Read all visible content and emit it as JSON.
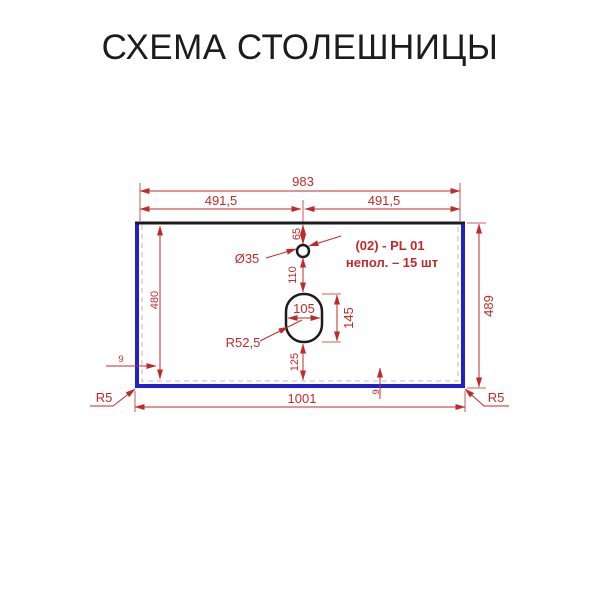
{
  "title": "СХЕМА СТОЛЕШНИЦЫ",
  "colors": {
    "dimension": "#c22a2a",
    "edge": "#2121cc",
    "outline": "#1c1c1c",
    "background": "#ffffff"
  },
  "diagram": {
    "dims": {
      "top_total": "983",
      "top_left": "491,5",
      "top_right": "491,5",
      "hole_offset": "65",
      "hole_dia": "Ø35",
      "hole_to_cutout": "110",
      "cutout_width": "105",
      "cutout_height": "145",
      "cutout_radius": "R52,5",
      "cutout_bottom": "125",
      "inner_height": "480",
      "edge_left": "9",
      "edge_bottom": "9",
      "outer_height": "489",
      "outer_width": "1001",
      "corner_left": "R5",
      "corner_right": "R5"
    },
    "note": {
      "line1": "(02) - PL 01",
      "line2": "непол. – 15 шт"
    }
  }
}
